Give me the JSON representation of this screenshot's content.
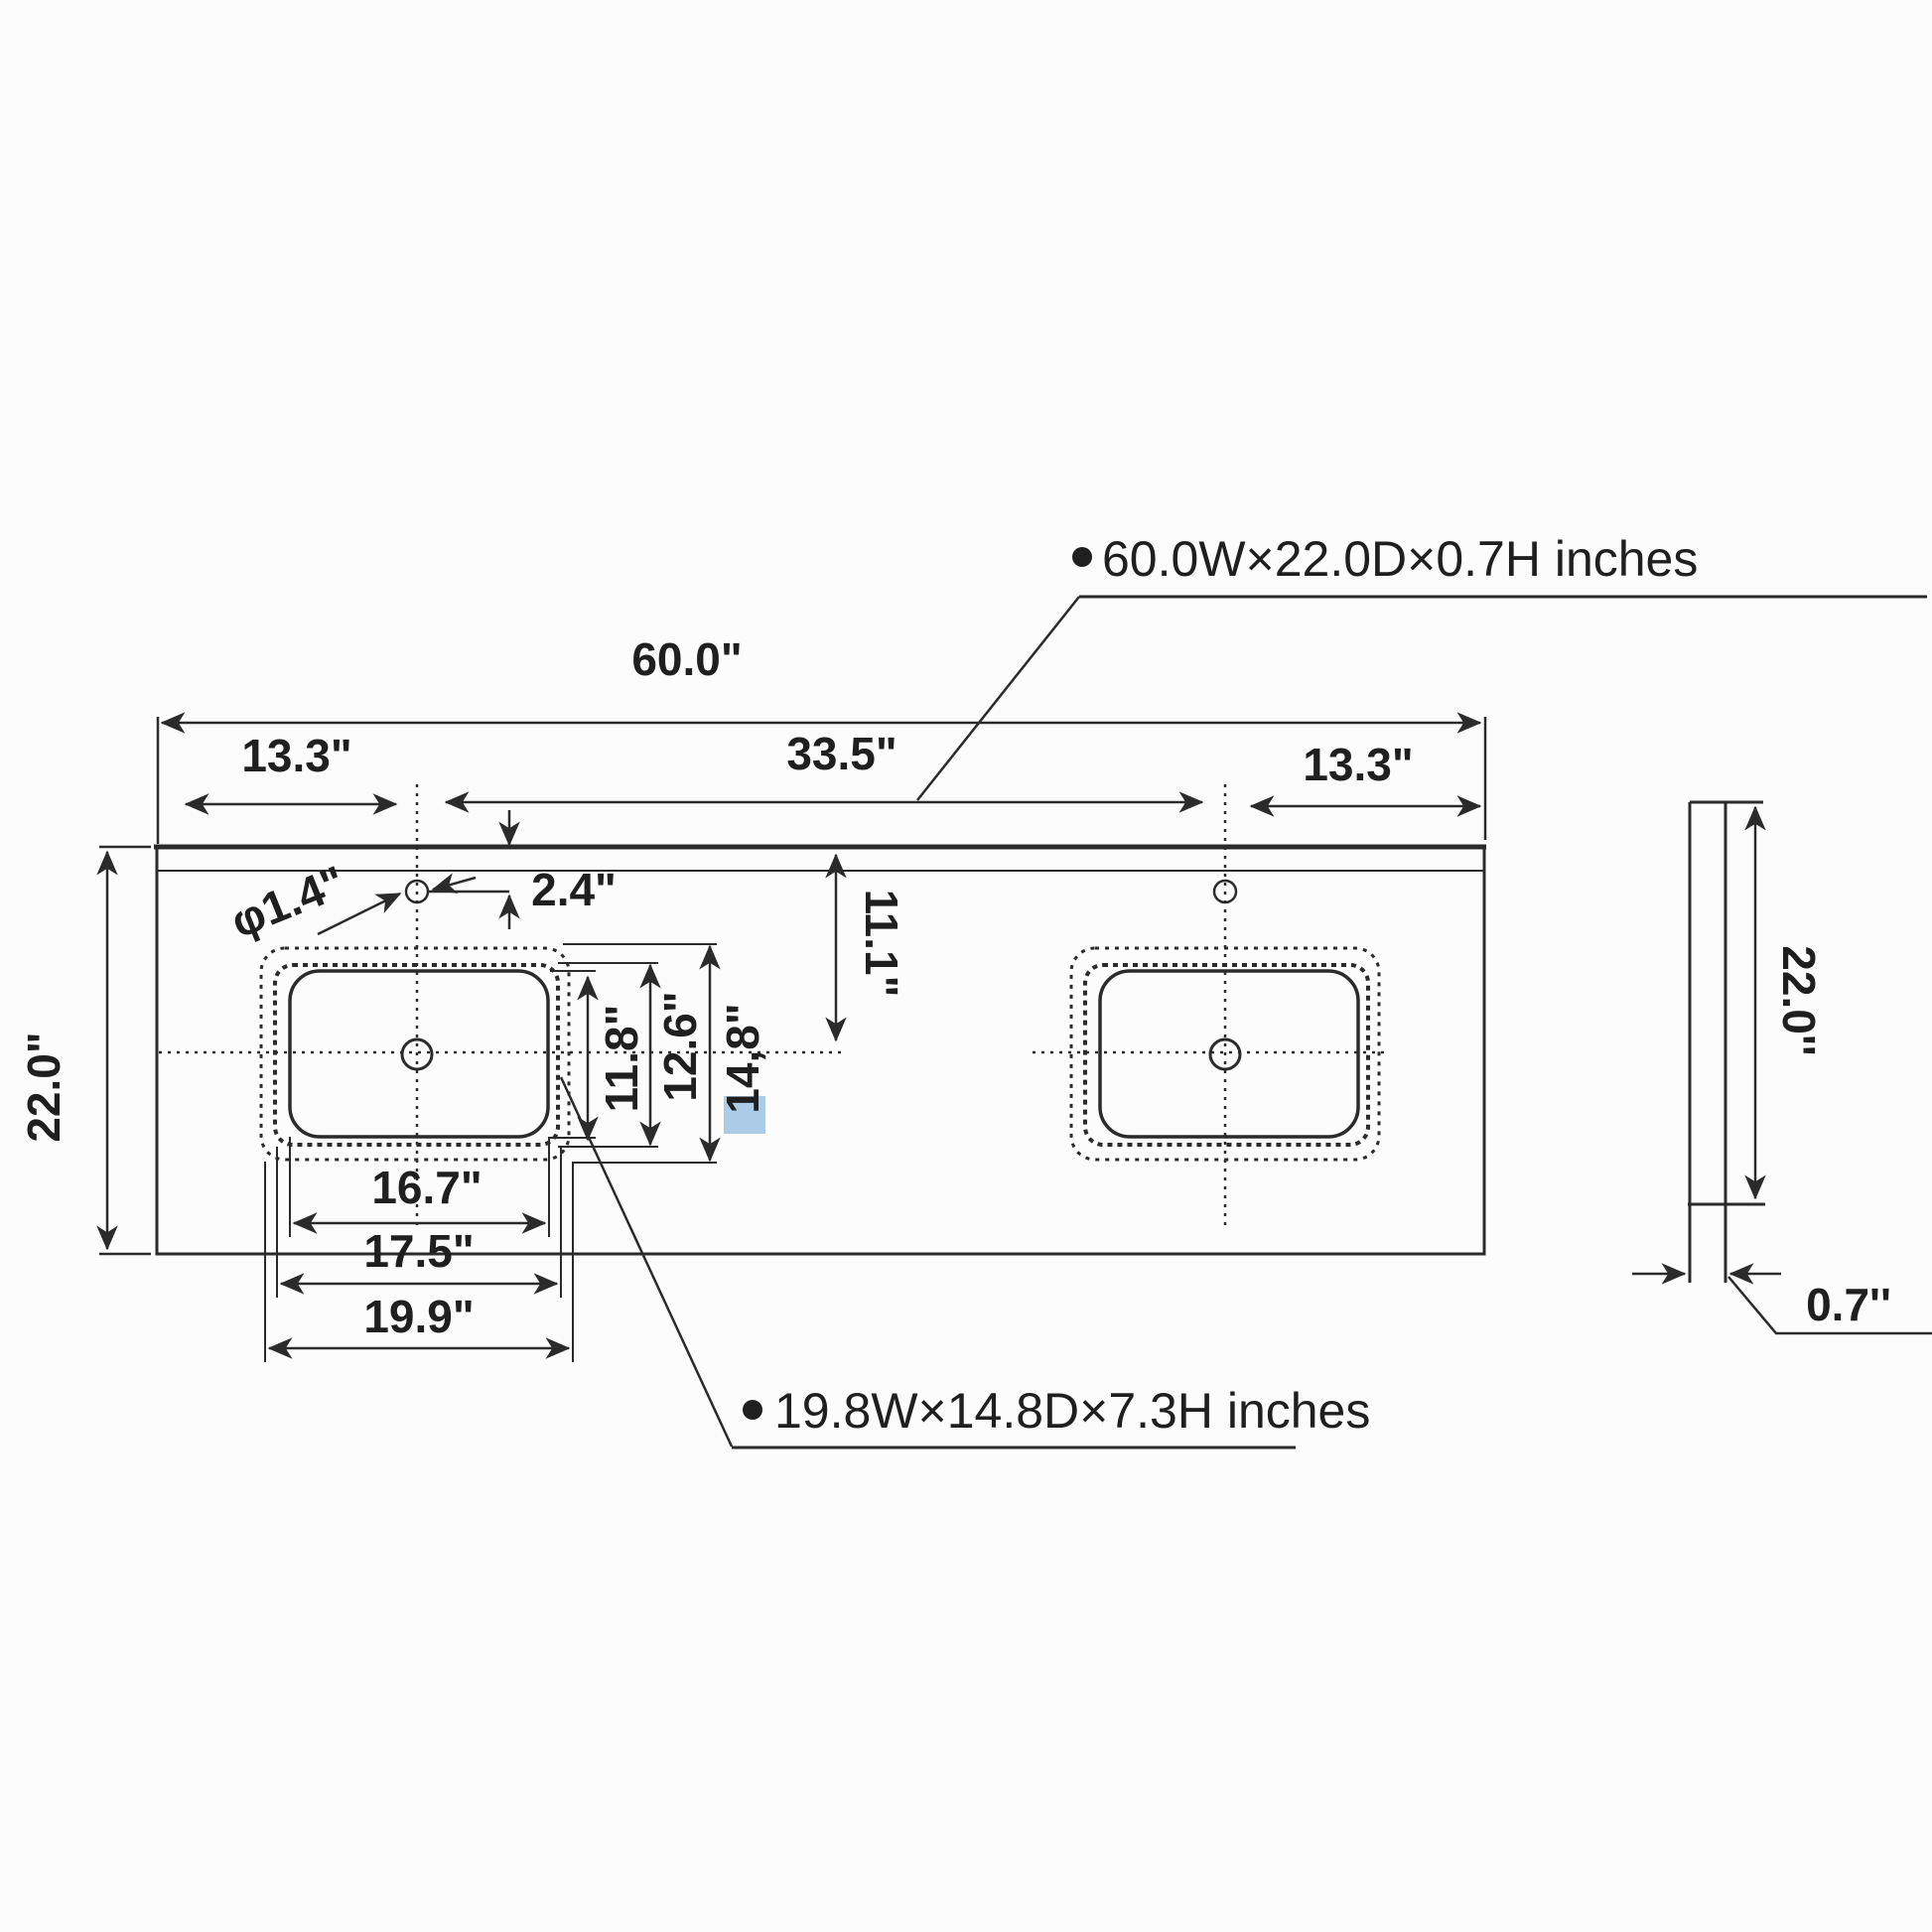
{
  "labels": {
    "total_width": "60.0\"",
    "left_offset": "13.3\"",
    "center_span": "33.5\"",
    "right_offset": "13.3\"",
    "depth_left": "22.0\"",
    "faucet_hole_diameter": "φ1.4\"",
    "faucet_offset": "2.4\"",
    "sink_center_from_back": "11.1\"",
    "bowl_inner_depth": "11.8\"",
    "bowl_middle_depth": "12.6\"",
    "cutout_depth": "14,8\"",
    "bowl_inner_width": "16.7\"",
    "bowl_middle_width": "17.5\"",
    "cutout_width": "19.9\"",
    "side_depth": "22.0''",
    "side_thickness": "0.7''"
  },
  "callouts": {
    "countertop": "60.0W×22.0D×0.7H inches",
    "sink": "19.8W×14.8D×7.3H inches"
  },
  "colors": {
    "line": "#2b2b2b",
    "text": "#1f1f1f",
    "highlight": "#abcbe6",
    "background": "#fcfcfc"
  }
}
